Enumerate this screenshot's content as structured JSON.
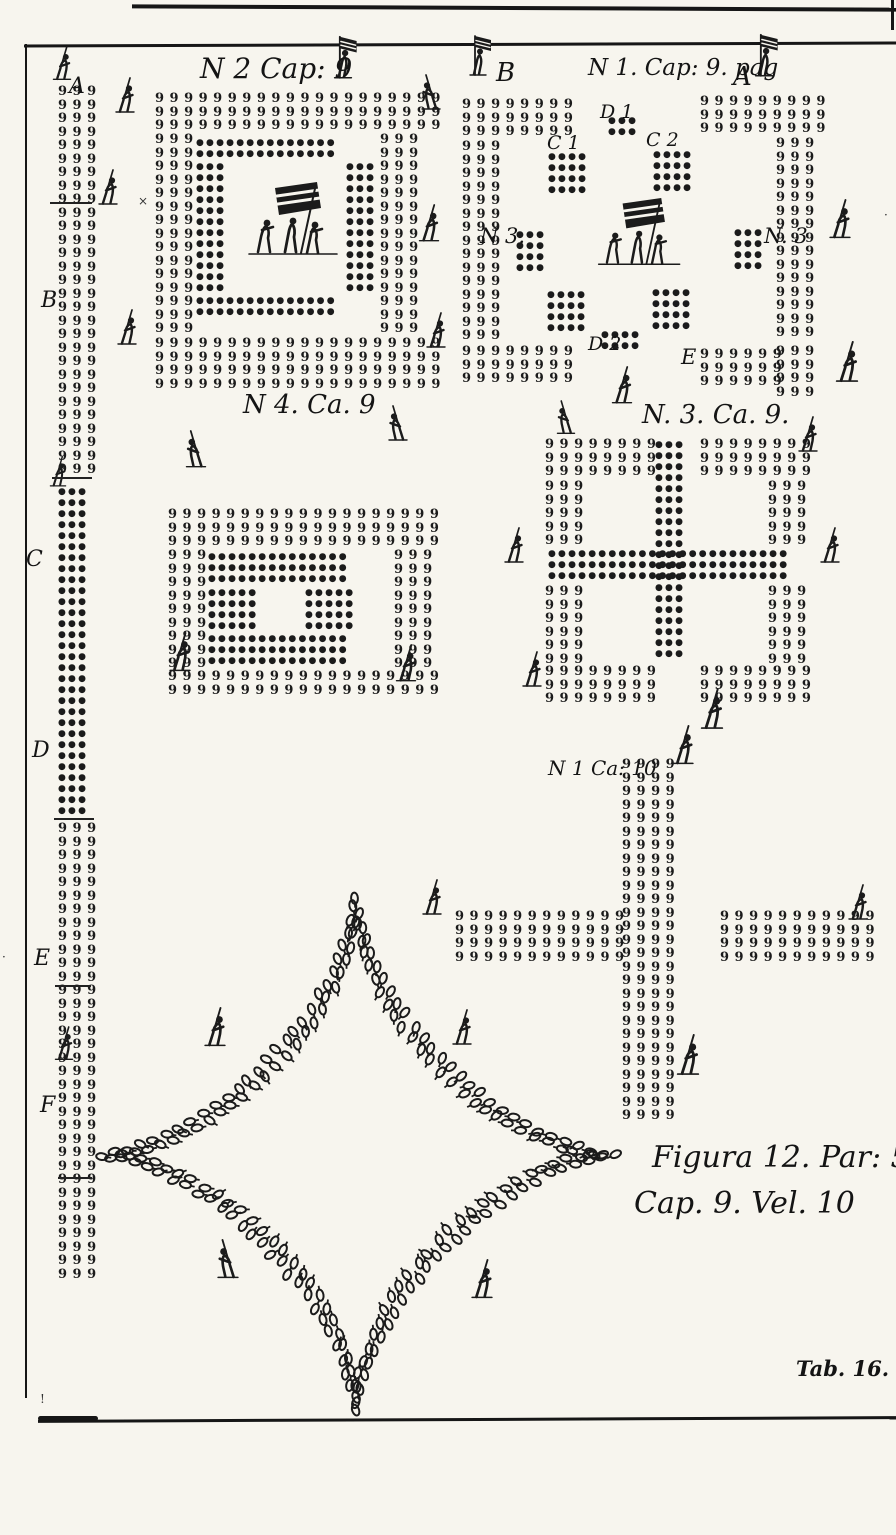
{
  "page": {
    "background": "#f7f5ee",
    "ink": "#1b1b1b",
    "width": 896,
    "height": 1535
  },
  "captions": {
    "figura_line1": "Figura 12. Par: 5.",
    "figura_line2": "Cap. 9. Vel. 10",
    "tab_label": "Tab. 16."
  },
  "glyphs": {
    "pike_soldier": "9",
    "musketeer": "●"
  },
  "labels": [
    {
      "id": "n2cap9",
      "text": "N 2 Cap: 9",
      "x": 200,
      "y": 52,
      "size": 28,
      "italic": true
    },
    {
      "id": "b-top",
      "text": "B",
      "x": 496,
      "y": 58,
      "size": 26,
      "italic": true
    },
    {
      "id": "n1cap9",
      "text": "N 1. Cap: 9. pag",
      "x": 588,
      "y": 55,
      "size": 23,
      "italic": true
    },
    {
      "id": "a-top",
      "text": "A",
      "x": 733,
      "y": 62,
      "size": 26,
      "italic": true
    },
    {
      "id": "d1",
      "text": "D 1",
      "x": 600,
      "y": 101,
      "size": 19,
      "italic": true
    },
    {
      "id": "c1",
      "text": "C 1",
      "x": 547,
      "y": 132,
      "size": 19,
      "italic": true
    },
    {
      "id": "c2",
      "text": "C 2",
      "x": 646,
      "y": 129,
      "size": 19,
      "italic": true
    },
    {
      "id": "n3-left",
      "text": "N 3.",
      "x": 480,
      "y": 224,
      "size": 21,
      "italic": true
    },
    {
      "id": "n3-right",
      "text": "N. 3",
      "x": 764,
      "y": 224,
      "size": 21,
      "italic": true
    },
    {
      "id": "d2",
      "text": "D 2",
      "x": 588,
      "y": 333,
      "size": 19,
      "italic": true
    },
    {
      "id": "e-label",
      "text": "E",
      "x": 681,
      "y": 345,
      "size": 21,
      "italic": true
    },
    {
      "id": "n4ca9",
      "text": "N 4. Ca. 9",
      "x": 243,
      "y": 390,
      "size": 26,
      "italic": true
    },
    {
      "id": "n3ca9",
      "text": "N. 3. Ca. 9.",
      "x": 642,
      "y": 400,
      "size": 26,
      "italic": true
    },
    {
      "id": "n1ca10",
      "text": "N 1 Ca: 10",
      "x": 548,
      "y": 756,
      "size": 20,
      "italic": true
    },
    {
      "id": "col-a",
      "text": "A",
      "x": 69,
      "y": 74,
      "size": 22,
      "italic": true
    },
    {
      "id": "col-b",
      "text": "B",
      "x": 41,
      "y": 288,
      "size": 22,
      "italic": true
    },
    {
      "id": "col-c",
      "text": "C",
      "x": 26,
      "y": 547,
      "size": 22,
      "italic": true
    },
    {
      "id": "col-d",
      "text": "D",
      "x": 32,
      "y": 738,
      "size": 22,
      "italic": true
    },
    {
      "id": "col-e",
      "text": "E",
      "x": 34,
      "y": 946,
      "size": 22,
      "italic": true
    },
    {
      "id": "col-f",
      "text": "F",
      "x": 40,
      "y": 1093,
      "size": 22,
      "italic": true
    }
  ],
  "formations": [
    {
      "name": "left-march-column",
      "blocks": [
        {
          "glyph": "q",
          "x": 58,
          "y": 85,
          "cols": 3,
          "rows": 29
        },
        {
          "glyph": "dot",
          "x": 58,
          "y": 487,
          "cols": 3,
          "rows": 30
        },
        {
          "glyph": "q",
          "x": 58,
          "y": 822,
          "cols": 3,
          "rows": 34
        }
      ]
    },
    {
      "name": "square-n2-cap9",
      "blocks": [
        {
          "glyph": "q",
          "x": 155,
          "y": 92,
          "cols": 20,
          "rows": 3
        },
        {
          "glyph": "q",
          "x": 155,
          "y": 133,
          "cols": 3,
          "rows": 15
        },
        {
          "glyph": "q",
          "x": 380,
          "y": 133,
          "cols": 3,
          "rows": 15
        },
        {
          "glyph": "q",
          "x": 155,
          "y": 337,
          "cols": 20,
          "rows": 4
        },
        {
          "glyph": "dot",
          "x": 196,
          "y": 138,
          "cols": 14,
          "rows": 2
        },
        {
          "glyph": "dot",
          "x": 196,
          "y": 162,
          "cols": 3,
          "rows": 12
        },
        {
          "glyph": "dot",
          "x": 346,
          "y": 162,
          "cols": 3,
          "rows": 12
        },
        {
          "glyph": "dot",
          "x": 196,
          "y": 296,
          "cols": 14,
          "rows": 2
        }
      ]
    },
    {
      "name": "cross-n1-cap9-pag",
      "blocks": [
        {
          "glyph": "q",
          "x": 462,
          "y": 98,
          "cols": 8,
          "rows": 3
        },
        {
          "glyph": "q",
          "x": 462,
          "y": 140,
          "cols": 3,
          "rows": 15
        },
        {
          "glyph": "q",
          "x": 462,
          "y": 345,
          "cols": 8,
          "rows": 3
        },
        {
          "glyph": "q",
          "x": 700,
          "y": 95,
          "cols": 9,
          "rows": 3
        },
        {
          "glyph": "q",
          "x": 776,
          "y": 137,
          "cols": 3,
          "rows": 15
        },
        {
          "glyph": "q",
          "x": 776,
          "y": 345,
          "cols": 3,
          "rows": 4
        },
        {
          "glyph": "q",
          "x": 700,
          "y": 348,
          "cols": 6,
          "rows": 3
        },
        {
          "glyph": "dot",
          "x": 608,
          "y": 116,
          "cols": 3,
          "rows": 2
        },
        {
          "glyph": "dot",
          "x": 548,
          "y": 152,
          "cols": 4,
          "rows": 4
        },
        {
          "glyph": "dot",
          "x": 653,
          "y": 150,
          "cols": 4,
          "rows": 4
        },
        {
          "glyph": "dot",
          "x": 516,
          "y": 230,
          "cols": 3,
          "rows": 4
        },
        {
          "glyph": "dot",
          "x": 734,
          "y": 228,
          "cols": 3,
          "rows": 4
        },
        {
          "glyph": "dot",
          "x": 547,
          "y": 290,
          "cols": 4,
          "rows": 4
        },
        {
          "glyph": "dot",
          "x": 652,
          "y": 288,
          "cols": 4,
          "rows": 4
        },
        {
          "glyph": "dot",
          "x": 601,
          "y": 330,
          "cols": 4,
          "rows": 2
        }
      ]
    },
    {
      "name": "square-n4-ca9",
      "blocks": [
        {
          "glyph": "q",
          "x": 168,
          "y": 508,
          "cols": 19,
          "rows": 3
        },
        {
          "glyph": "q",
          "x": 168,
          "y": 549,
          "cols": 3,
          "rows": 9
        },
        {
          "glyph": "q",
          "x": 394,
          "y": 549,
          "cols": 3,
          "rows": 9
        },
        {
          "glyph": "q",
          "x": 168,
          "y": 670,
          "cols": 19,
          "rows": 2
        },
        {
          "glyph": "dot",
          "x": 208,
          "y": 552,
          "cols": 14,
          "rows": 3
        },
        {
          "glyph": "dot",
          "x": 208,
          "y": 588,
          "cols": 5,
          "rows": 4
        },
        {
          "glyph": "dot",
          "x": 305,
          "y": 588,
          "cols": 5,
          "rows": 4
        },
        {
          "glyph": "dot",
          "x": 208,
          "y": 634,
          "cols": 14,
          "rows": 3
        }
      ]
    },
    {
      "name": "square-cross-n3-ca9",
      "blocks": [
        {
          "glyph": "q",
          "x": 545,
          "y": 438,
          "cols": 8,
          "rows": 3
        },
        {
          "glyph": "q",
          "x": 700,
          "y": 438,
          "cols": 8,
          "rows": 3
        },
        {
          "glyph": "q",
          "x": 545,
          "y": 480,
          "cols": 3,
          "rows": 5
        },
        {
          "glyph": "q",
          "x": 768,
          "y": 480,
          "cols": 3,
          "rows": 5
        },
        {
          "glyph": "q",
          "x": 545,
          "y": 585,
          "cols": 3,
          "rows": 6
        },
        {
          "glyph": "q",
          "x": 768,
          "y": 585,
          "cols": 3,
          "rows": 6
        },
        {
          "glyph": "q",
          "x": 545,
          "y": 665,
          "cols": 8,
          "rows": 3
        },
        {
          "glyph": "q",
          "x": 700,
          "y": 665,
          "cols": 8,
          "rows": 3
        },
        {
          "glyph": "dot",
          "x": 655,
          "y": 440,
          "cols": 3,
          "rows": 20
        },
        {
          "glyph": "dot",
          "x": 548,
          "y": 549,
          "cols": 24,
          "rows": 3
        }
      ]
    },
    {
      "name": "cross-n1-ca10",
      "blocks": [
        {
          "glyph": "q",
          "x": 622,
          "y": 758,
          "cols": 4,
          "rows": 27
        },
        {
          "glyph": "q",
          "x": 455,
          "y": 910,
          "cols": 12,
          "rows": 4
        },
        {
          "glyph": "q",
          "x": 720,
          "y": 910,
          "cols": 11,
          "rows": 4
        }
      ]
    }
  ],
  "figures": {
    "pikemen": [
      [
        125,
        98,
        1,
        1
      ],
      [
        108,
        190,
        1,
        1
      ],
      [
        127,
        330,
        1,
        1
      ],
      [
        431,
        95,
        -1,
        1
      ],
      [
        429,
        226,
        1,
        1.05
      ],
      [
        436,
        333,
        1,
        1
      ],
      [
        840,
        222,
        1,
        1.1
      ],
      [
        847,
        365,
        1,
        1.15
      ],
      [
        808,
        437,
        1,
        1
      ],
      [
        622,
        388,
        1,
        1.05
      ],
      [
        566,
        420,
        -1,
        0.95
      ],
      [
        196,
        452,
        -1,
        1.05
      ],
      [
        398,
        426,
        -1,
        1
      ],
      [
        180,
        655,
        1,
        1.1
      ],
      [
        406,
        666,
        1,
        1.05
      ],
      [
        514,
        548,
        1,
        1
      ],
      [
        532,
        672,
        1,
        1
      ],
      [
        712,
        712,
        1,
        1.15
      ],
      [
        830,
        548,
        1,
        1
      ],
      [
        683,
        748,
        1,
        1.1
      ],
      [
        432,
        900,
        1,
        1
      ],
      [
        858,
        905,
        1,
        1
      ],
      [
        688,
        1058,
        1,
        1.15
      ],
      [
        215,
        1030,
        1,
        1.1
      ],
      [
        462,
        1030,
        1,
        1
      ],
      [
        228,
        1262,
        -1,
        1.1
      ],
      [
        482,
        1282,
        1,
        1.1
      ],
      [
        62,
        66,
        1,
        0.95
      ],
      [
        58,
        474,
        1,
        0.85
      ],
      [
        64,
        1046,
        1,
        0.95
      ]
    ],
    "ensigns": [
      [
        343,
        62,
        1,
        1.05
      ],
      [
        478,
        60,
        1,
        1
      ],
      [
        764,
        60,
        1,
        1.05
      ]
    ],
    "flag_groups": [
      [
        245,
        182,
        1.0
      ],
      [
        595,
        198,
        0.92
      ]
    ]
  },
  "star": {
    "cx": 356,
    "cy": 1155,
    "r_outer": 258,
    "r_inner": 238,
    "spacing": 13
  },
  "separators": [
    {
      "x": 50,
      "y": 202,
      "w": 42
    },
    {
      "x": 52,
      "y": 477,
      "w": 40
    },
    {
      "x": 54,
      "y": 818,
      "w": 40
    },
    {
      "x": 55,
      "y": 985,
      "w": 36
    },
    {
      "x": 58,
      "y": 1177,
      "w": 34
    }
  ],
  "marks": [
    {
      "x": 138,
      "y": 194,
      "t": "×"
    },
    {
      "x": 40,
      "y": 1392,
      "t": "!"
    },
    {
      "x": 2,
      "y": 950,
      "t": "·"
    },
    {
      "x": 884,
      "y": 208,
      "t": "·"
    }
  ]
}
